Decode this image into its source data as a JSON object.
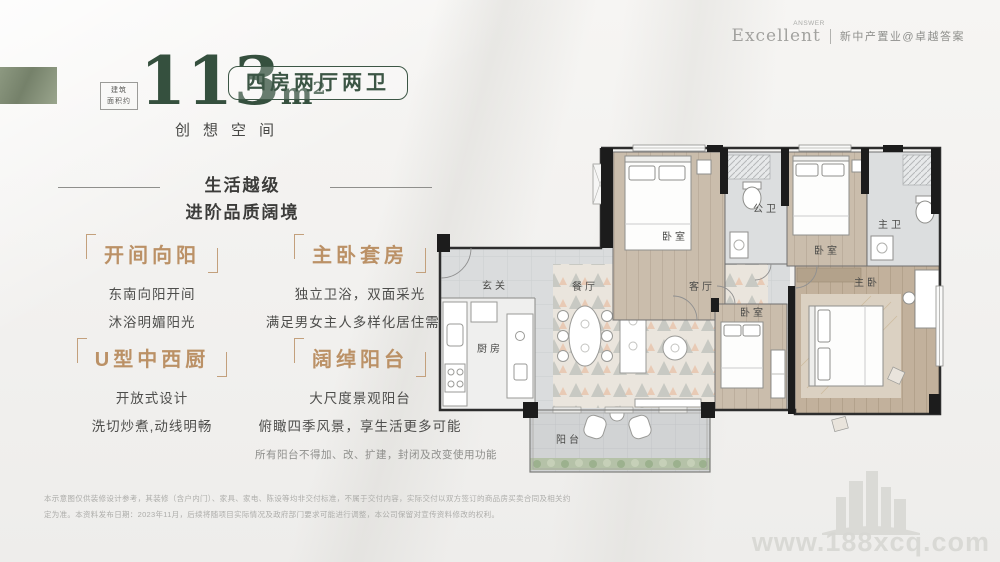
{
  "brand": {
    "logo_text": "Excellent",
    "logo_sup": "ANSWER",
    "tagline": "新中产置业@卓越答案"
  },
  "headline": {
    "area_label_top": "建筑",
    "area_label_bottom": "面积约",
    "area_value": "113",
    "area_unit": "m²",
    "type_badge": "四房两厅两卫",
    "slogan": "创想空间"
  },
  "section": {
    "line1": "生活越级",
    "line2": "进阶品质阔境"
  },
  "features": [
    {
      "title": "开间向阳",
      "lines": [
        "东南向阳开间",
        "沐浴明媚阳光"
      ]
    },
    {
      "title": "主卧套房",
      "lines": [
        "独立卫浴，双面采光",
        "满足男女主人多样化居住需求"
      ]
    },
    {
      "title": "U型中西厨",
      "lines": [
        "开放式设计",
        "洗切炒煮,动线明畅"
      ]
    },
    {
      "title": "阔绰阳台",
      "lines": [
        "大尺度景观阳台",
        "俯瞰四季风景，享生活更多可能"
      ]
    }
  ],
  "floorplan": {
    "rooms": {
      "bedroom1": "卧室",
      "public_bath": "公卫",
      "bedroom2": "卧室",
      "master_bath": "主卫",
      "entry": "玄关",
      "dining": "餐厅",
      "living": "客厅",
      "kitchen": "厨房",
      "bedroom3": "卧室",
      "master_bedroom": "主卧",
      "balcony": "阳台"
    },
    "note": "所有阳台不得加、改、扩建，封闭及改变使用功能"
  },
  "disclaimer": {
    "line1": "本示意图仅供装修设计参考，其装修（含户内门）、家具、家电、陈设等均非交付标准，不属于交付内容，实际交付以双方签订的商品房买卖合同及相关约",
    "line2": "定为准。本资料发布日期：2023年11月，后续将随项目实际情况及政府部门要求可能进行调整，本公司保留对宣传资料修改的权利。"
  },
  "watermark": {
    "site": "www.188xcq.com"
  },
  "colors": {
    "green": "#35503e",
    "tan": "#bb9166",
    "text_dark": "#3c3c3a"
  }
}
